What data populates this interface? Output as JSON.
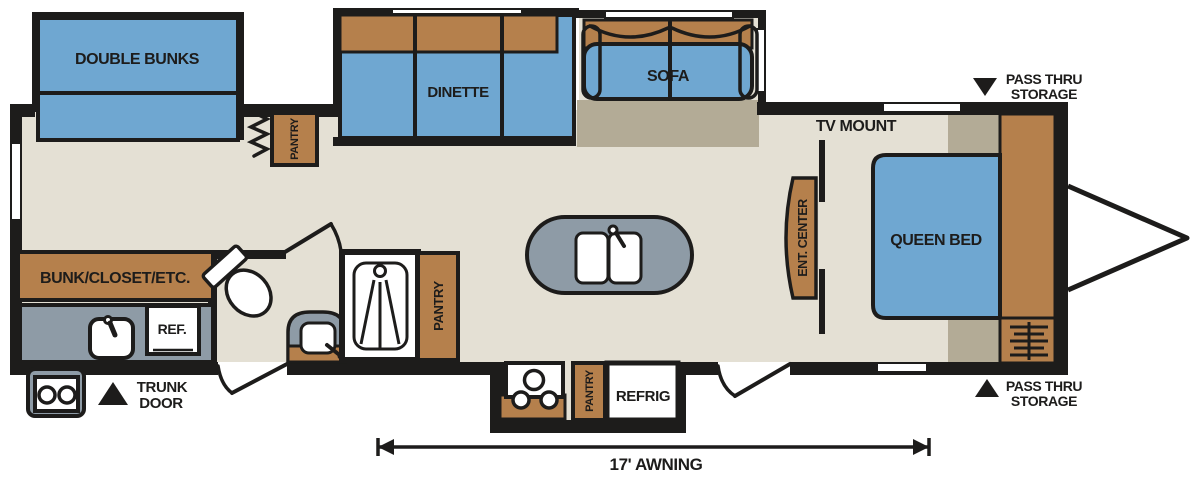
{
  "diagram_type": "travel-trailer-floorplan",
  "labels": {
    "double_bunks": "DOUBLE BUNKS",
    "dinette": "DINETTE",
    "sofa": "SOFA",
    "pantry_hall": "PANTRY",
    "pantry_kitchen": "PANTRY",
    "pantry_outdoor": "PANTRY",
    "tv_mount": "TV MOUNT",
    "ent_center": "ENT. CENTER",
    "queen_bed": "QUEEN BED",
    "bunk_closet": "BUNK/CLOSET/ETC.",
    "ref": "REF.",
    "refrig": "REFRIG",
    "awning": "17' AWNING",
    "pass_thru_line1": "PASS THRU",
    "pass_thru_line2": "STORAGE",
    "trunk_line1": "TRUNK",
    "trunk_line2": "DOOR"
  },
  "markers": {
    "pass_thru_top_icon": "▼",
    "pass_thru_bottom_icon": "▲",
    "trunk_door_icon": "▲"
  },
  "colors": {
    "furniture_blue": "#6FA7D1",
    "cabinet_brown": "#B5804C",
    "counter_gray": "#8E9BA6",
    "floor_beige": "#E4E0D4",
    "slide_floor_tan": "#B3AB96",
    "outline_black": "#1D1C1B"
  }
}
